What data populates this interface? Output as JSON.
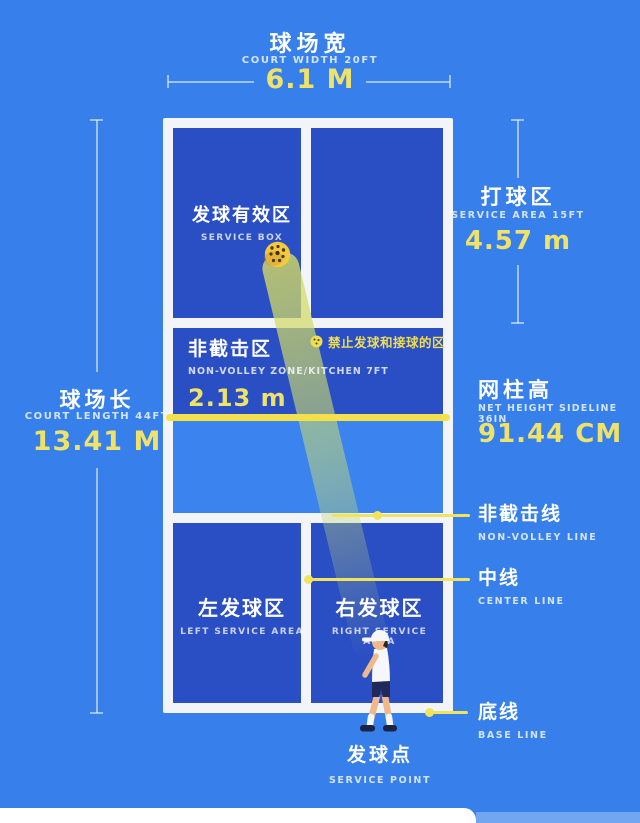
{
  "colors": {
    "background": "#3780EB",
    "court_fill": "#2A4EC4",
    "kitchen_near_fill": "#3B83EE",
    "line_white": "#F2F4F8",
    "net_yellow": "#F4E04A",
    "value_yellow": "#EFE26A",
    "callout_yellow": "#F0E45C"
  },
  "top_measure": {
    "label_cn": "球场宽",
    "label_en": "COURT WIDTH 20FT",
    "value": "6.1 M"
  },
  "left_measure": {
    "label_cn": "球场长",
    "label_en": "COURT LENGTH 44FT",
    "value": "13.41 M"
  },
  "service_area_measure": {
    "label_cn": "打球区",
    "label_en": "SERVICE AREA 15FT",
    "value": "4.57 m"
  },
  "net_height_measure": {
    "label_cn": "网柱高",
    "label_en": "NET HEIGHT SIDELINE 36IN",
    "value": "91.44 CM"
  },
  "court": {
    "service_box": {
      "label_cn": "发球有效区",
      "label_en": "SERVICE BOX"
    },
    "kitchen": {
      "label_cn": "非截击区",
      "label_en": "NON-VOLLEY ZONE/KITCHEN 7FT",
      "value": "2.13 m"
    },
    "no_serve_note": "禁止发球和接球的区",
    "left_service": {
      "label_cn": "左发球区",
      "label_en": "LEFT SERVICE AREA"
    },
    "right_service": {
      "label_cn": "右发球区",
      "label_en": "RIGHT SERVICE AREA"
    }
  },
  "callouts": {
    "non_volley_line": {
      "label_cn": "非截击线",
      "label_en": "NON-VOLLEY LINE"
    },
    "center_line": {
      "label_cn": "中线",
      "label_en": "CENTER LINE"
    },
    "base_line": {
      "label_cn": "底线",
      "label_en": "BASE LINE"
    }
  },
  "service_point": {
    "label_cn": "发球点",
    "label_en": "SERVICE POINT"
  }
}
